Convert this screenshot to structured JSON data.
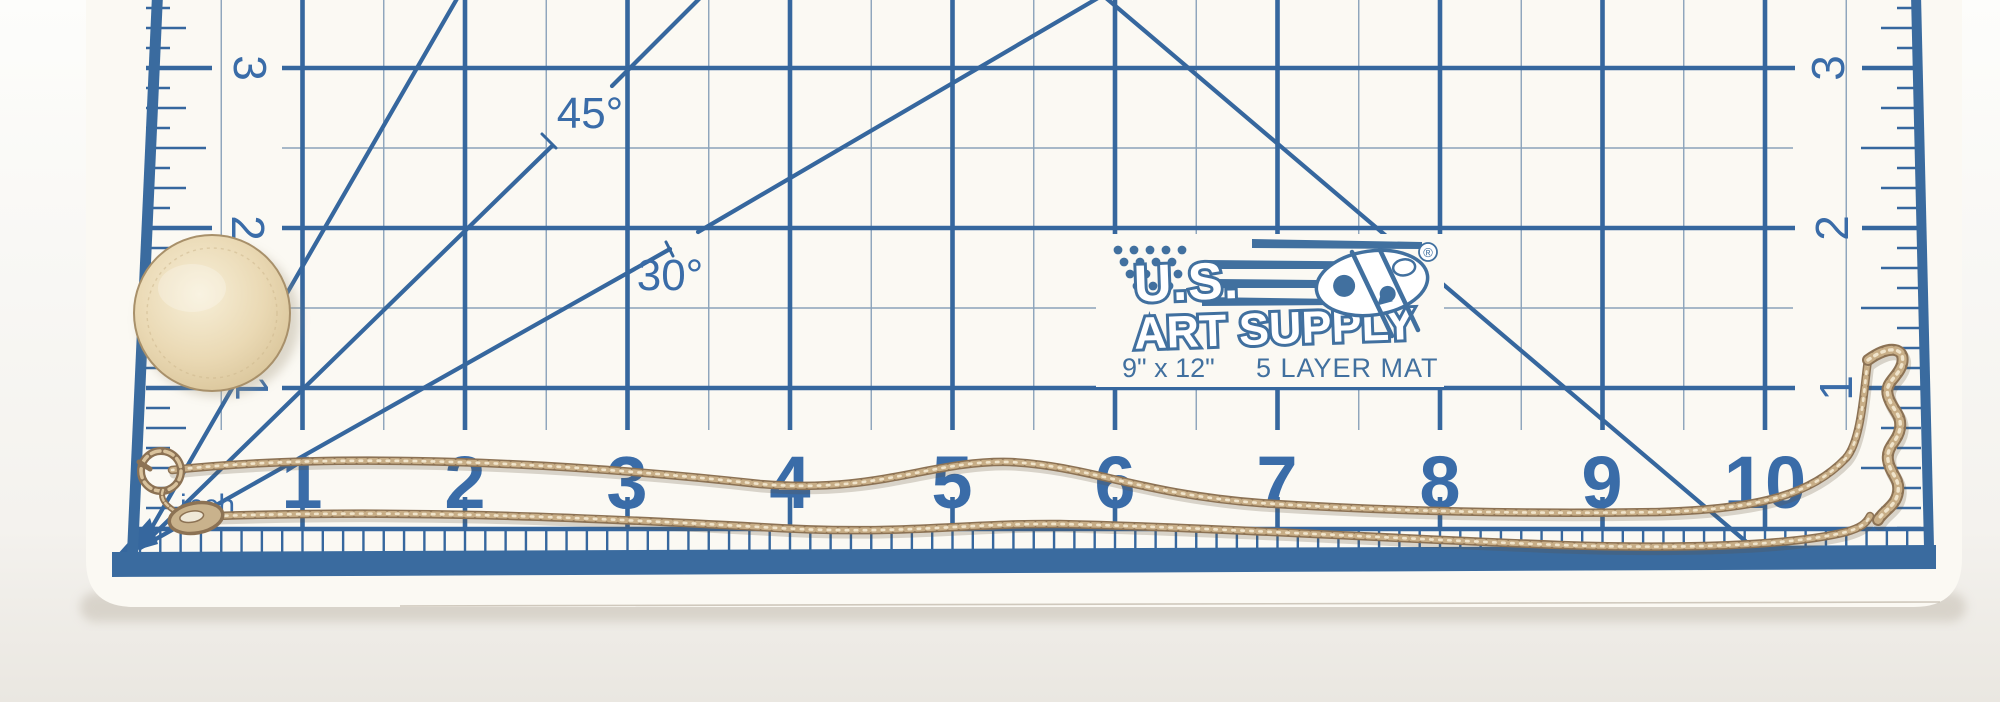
{
  "background": {
    "top_color": "#fdfdfb",
    "bottom_color": "#eae7e1"
  },
  "mat": {
    "surface_color": "#fbf9f3",
    "grid_color": "#36679e",
    "thin_line_color": "#8ba2ba",
    "number_color": "#3a6ca8",
    "edge_band_color": "#3a6b9f",
    "bottom_numbers": [
      "1",
      "2",
      "3",
      "4",
      "5",
      "6",
      "7",
      "8",
      "9",
      "10"
    ],
    "left_numbers": [
      "3",
      "2",
      "1"
    ],
    "right_numbers": [
      "3",
      "2",
      "1"
    ],
    "angle_labels": {
      "deg45": "45°",
      "deg30": "30°"
    },
    "unit_label": "inch"
  },
  "logo": {
    "brand_top": "U.S.",
    "brand_bottom": "ART SUPPLY",
    "registered": "®",
    "size_text": "9\" x 12\"",
    "layer_text": "5 LAYER MAT",
    "color": "#41709f"
  },
  "objects": {
    "coin_color": "#ead9b4",
    "chain_color": "#c8ae87",
    "chain_dark": "#8c7254",
    "chain_light": "#f0e4cb"
  }
}
